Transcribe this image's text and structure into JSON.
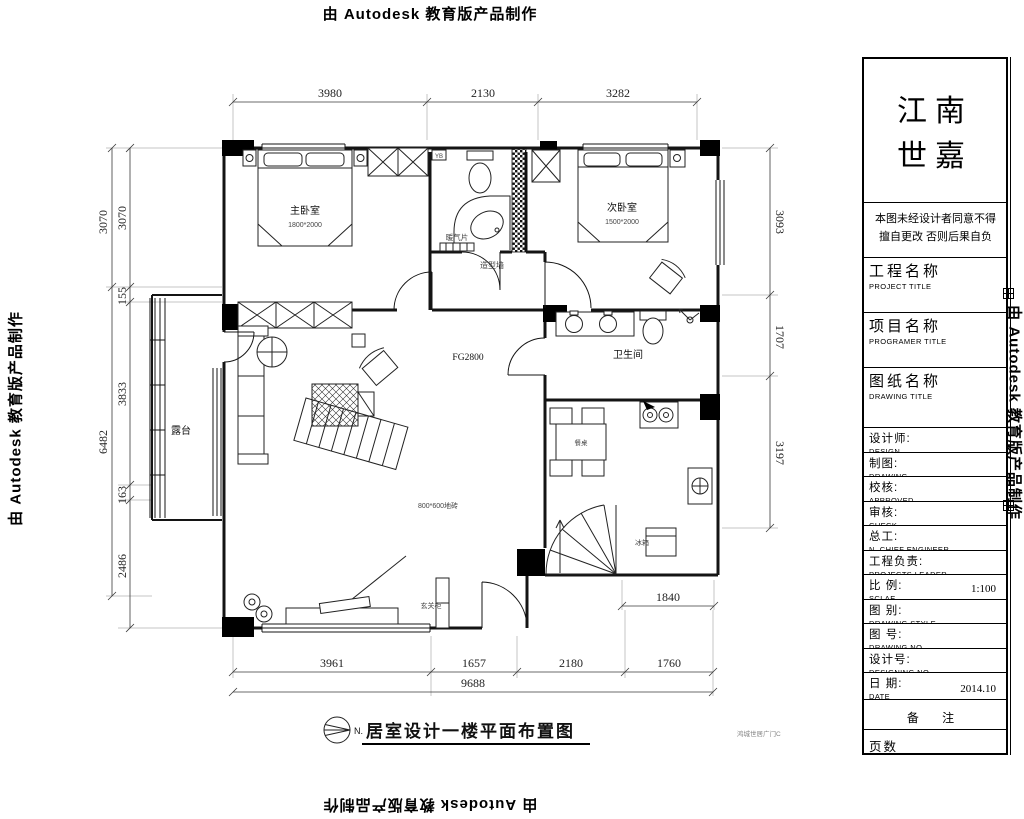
{
  "watermark": "由 Autodesk 教育版产品制作",
  "plan": {
    "labels": {
      "master_bedroom": "主卧室",
      "master_bed_size": "1800*2000",
      "second_bedroom": "次卧室",
      "second_bed_size": "1500*2000",
      "bathroom": "卫生间",
      "terrace": "露台",
      "radiator": "暖气片",
      "feature_wall": "造型墙",
      "yb": "YB",
      "floor_height": "FG2800",
      "tile": "800*600地砖",
      "fridge": "冰箱",
      "dining_table": "餐桌",
      "entry_cabinet": "玄关柜"
    },
    "north": "N.",
    "caption": "居室设计一楼平面布置图",
    "footnote": "鸿城世居广门C"
  },
  "dims": {
    "top": [
      "3980",
      "2130",
      "3282"
    ],
    "bottom": [
      "3961",
      "1657",
      "2180",
      "1760"
    ],
    "bottom_total": "9688",
    "bottom_right": "1840",
    "left_outer": [
      "3070",
      "6482"
    ],
    "left_inner": [
      "3070",
      "155",
      "3833",
      "163",
      "2486"
    ],
    "right": [
      "3093",
      "1707",
      "3197"
    ]
  },
  "titleblock": {
    "brand1": "江南",
    "brand2": "世嘉",
    "disclaimer1": "本图未经设计者同意不得",
    "disclaimer2": "擅自更改 否则后果自负",
    "fields": [
      {
        "cn": "工程名称",
        "en": "PROJECT TITLE",
        "val": ""
      },
      {
        "cn": "项目名称",
        "en": "PROGRAMER TITLE",
        "val": ""
      },
      {
        "cn": "图纸名称",
        "en": "DRAWING TITLE",
        "val": ""
      },
      {
        "cn": "设计师:",
        "en": "DESIGN",
        "val": ""
      },
      {
        "cn": "制图:",
        "en": "DRAWING",
        "val": ""
      },
      {
        "cn": "校核:",
        "en": "APPROVED",
        "val": ""
      },
      {
        "cn": "审核:",
        "en": "CHECK",
        "val": ""
      },
      {
        "cn": "总工:",
        "en": "N. CHIEF ENGINEER",
        "val": ""
      },
      {
        "cn": "工程负责:",
        "en": "PROJECTS LEADER",
        "val": ""
      },
      {
        "cn": "比 例:",
        "en": "SCLAE",
        "val": "1:100"
      },
      {
        "cn": "图 别:",
        "en": "DRAWING STYLE",
        "val": ""
      },
      {
        "cn": "图 号:",
        "en": "DRAWING NO.",
        "val": ""
      },
      {
        "cn": "设计号:",
        "en": "DESIGNING NO",
        "val": ""
      },
      {
        "cn": "日 期:",
        "en": "DATE",
        "val": "2014.10"
      },
      {
        "cn": "备 注",
        "en": "",
        "val": ""
      },
      {
        "cn": "页数",
        "en": "",
        "val": ""
      }
    ]
  }
}
